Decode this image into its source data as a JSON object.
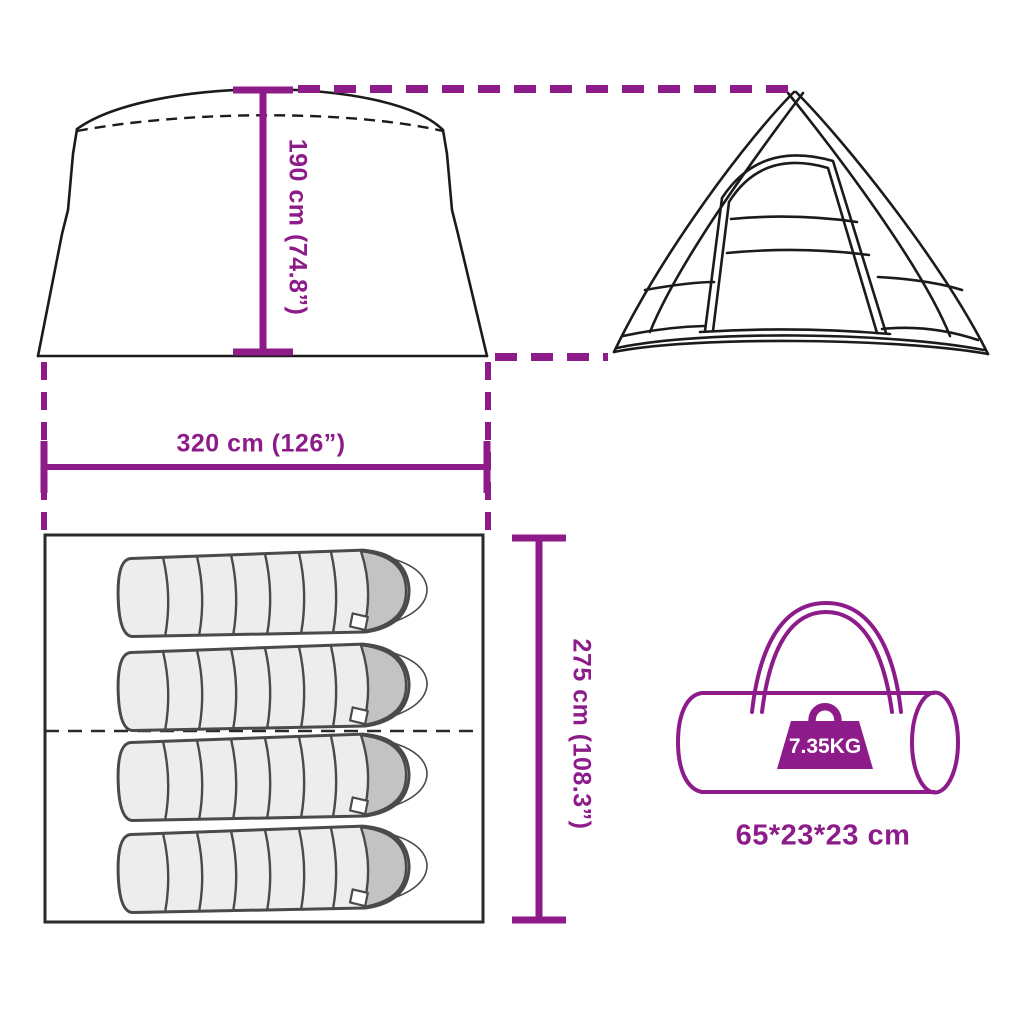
{
  "diagram": {
    "type": "product-dimension-diagram",
    "product": "camping tent with sleeping bags and carry bag",
    "colors": {
      "accent": "#8E1B8A",
      "line": "#1b1b1b",
      "bag_fill": "#ededed",
      "bag_cap": "#c3c3c3"
    },
    "views": {
      "front_view": {
        "name": "tent-front-view"
      },
      "side_view": {
        "name": "tent-side-view"
      },
      "floor_plan": {
        "name": "floor-plan-with-4-sleeping-bags",
        "sleeping_bag_count": 4
      },
      "carry_bag": {
        "name": "carry-bag-view"
      }
    },
    "labels": {
      "height": "190 cm (74.8”)",
      "width": "320 cm (126”)",
      "depth": "275 cm (108.3”)",
      "weight": "7.35KG",
      "bag_size": "65*23*23 cm"
    }
  }
}
